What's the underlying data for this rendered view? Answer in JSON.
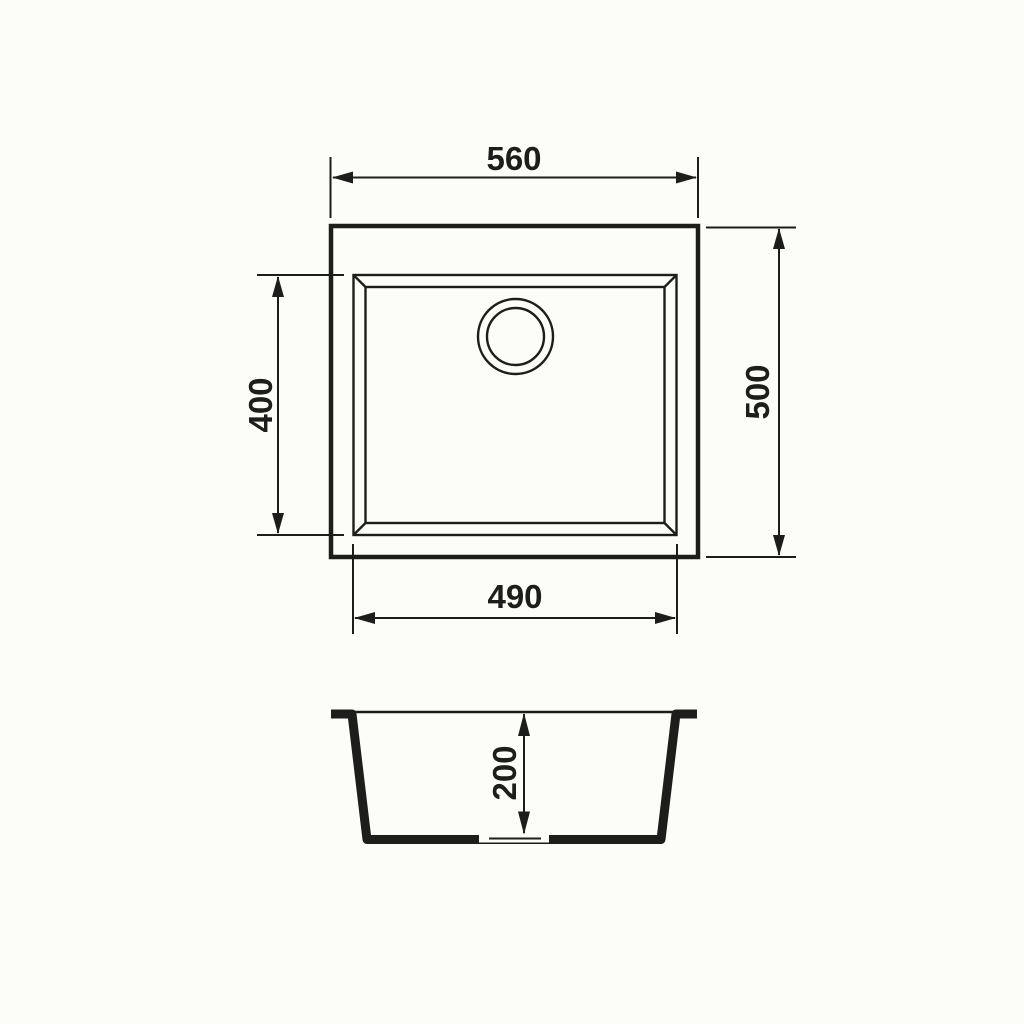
{
  "drawing": {
    "type": "technical dimension drawing",
    "colors": {
      "line": "#1d1d1b",
      "background": "#fcfcf8"
    },
    "top_view": {
      "overall_width_label": "560",
      "overall_height_label": "500",
      "bowl_width_label": "490",
      "bowl_height_label": "400"
    },
    "section_view": {
      "bowl_depth_label": "200"
    }
  }
}
